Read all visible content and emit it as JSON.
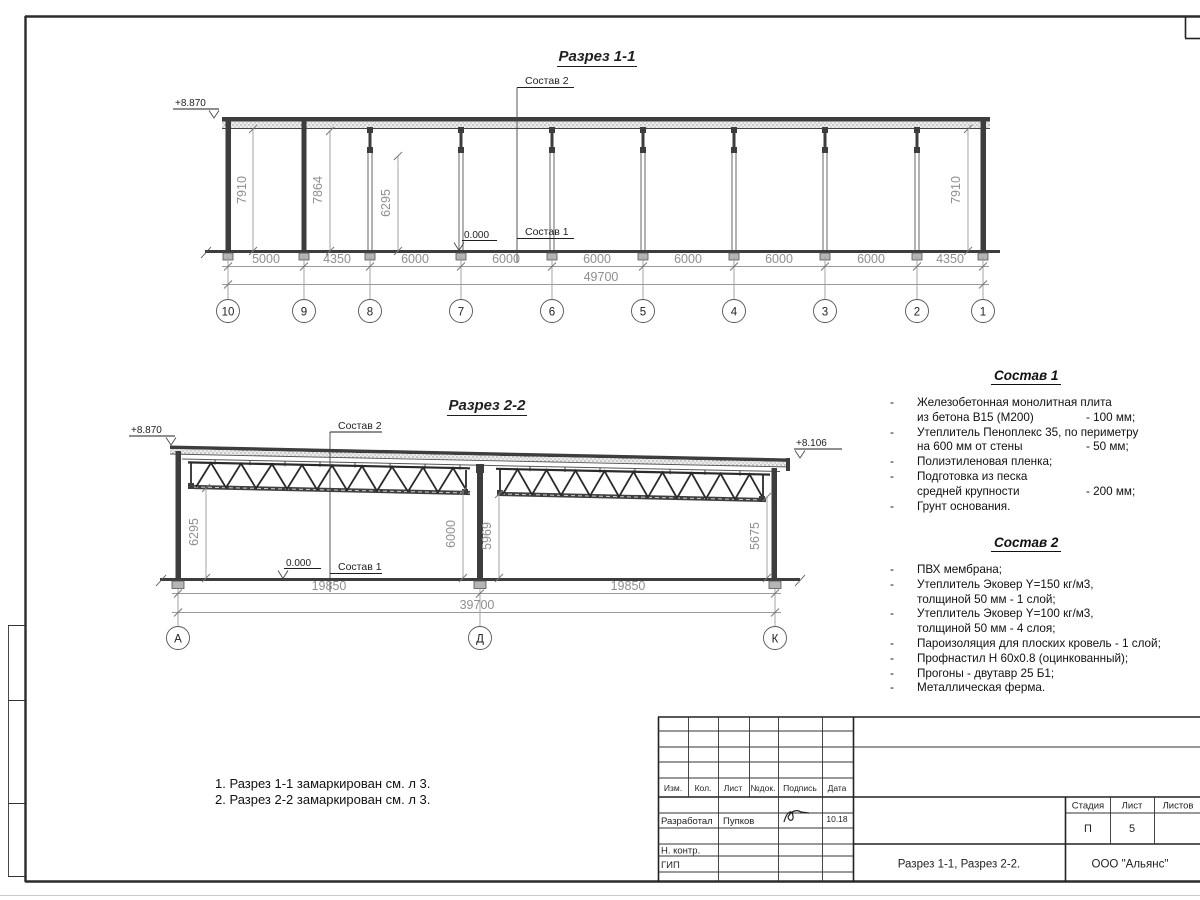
{
  "palette": {
    "ink": "#1f1f1f",
    "dim_grey": "#8f8f8f",
    "structure": "#3d3d3d",
    "footing": "#b5b5b5",
    "paper": "#ffffff"
  },
  "section1": {
    "title": "Разрез 1-1",
    "level_top": "+8.870",
    "level_zero": "0.000",
    "callout_top": "Состав 2",
    "callout_floor": "Состав 1",
    "dims_vertical": [
      "7910",
      "7864",
      "6295",
      "7910"
    ],
    "dims_bays": [
      "5000",
      "4350",
      "6000",
      "6000",
      "6000",
      "6000",
      "6000",
      "6000",
      "4350"
    ],
    "dim_total": "49700",
    "axes": [
      "10",
      "9",
      "8",
      "7",
      "6",
      "5",
      "4",
      "3",
      "2",
      "1"
    ]
  },
  "section2": {
    "title": "Разрез 2-2",
    "level_left": "+8.870",
    "level_right": "+8.106",
    "level_zero": "0.000",
    "callout_top": "Состав 2",
    "callout_floor": "Состав 1",
    "dims_vertical": [
      "6295",
      "6000",
      "5969",
      "5675"
    ],
    "dims_bays": [
      "19850",
      "19850"
    ],
    "dim_total": "39700",
    "axes": [
      "А",
      "Д",
      "К"
    ]
  },
  "sostav1": {
    "title": "Состав 1",
    "items": [
      {
        "d": "-",
        "t": "Железобетонная  монолитная плита",
        "v": ""
      },
      {
        "d": "",
        "t": "из бетона В15 (М200)",
        "v": "- 100 мм;"
      },
      {
        "d": "-",
        "t": "Утеплитель Пеноплекс 35, по периметру",
        "v": ""
      },
      {
        "d": "",
        "t": "на 600 мм от стены",
        "v": "- 50 мм;"
      },
      {
        "d": "-",
        "t": "Полиэтиленовая пленка;",
        "v": ""
      },
      {
        "d": "-",
        "t": "Подготовка из песка",
        "v": ""
      },
      {
        "d": "",
        "t": "средней крупности",
        "v": "- 200 мм;"
      },
      {
        "d": "-",
        "t": "Грунт основания.",
        "v": ""
      }
    ]
  },
  "sostav2": {
    "title": "Состав 2",
    "items": [
      {
        "d": "-",
        "t": "ПВХ мембрана;",
        "v": ""
      },
      {
        "d": "-",
        "t": "Утеплитель Эковер Y=150 кг/м3,",
        "v": ""
      },
      {
        "d": "",
        "t": "толщиной 50 мм - 1 слой;",
        "v": ""
      },
      {
        "d": "-",
        "t": "Утеплитель Эковер Y=100 кг/м3,",
        "v": ""
      },
      {
        "d": "",
        "t": "толщиной 50 мм - 4 слоя;",
        "v": ""
      },
      {
        "d": "-",
        "t": "Пароизоляция для плоских кровель - 1 слой;",
        "v": ""
      },
      {
        "d": "-",
        "t": "Профнастил Н 60х0.8 (оцинкованный);",
        "v": ""
      },
      {
        "d": "-",
        "t": "Прогоны - двутавр 25 Б1;",
        "v": ""
      },
      {
        "d": "-",
        "t": "Металлическая ферма.",
        "v": ""
      }
    ]
  },
  "notes": {
    "line1": "1. Разрез 1-1 замаркирован см. л 3.",
    "line2": "2. Разрез 2-2 замаркирован см. л 3."
  },
  "titleblock": {
    "rev_headers": [
      "Изм.",
      "Кол.",
      "Лист",
      "№док.",
      "Подпись",
      "Дата"
    ],
    "developed_label": "Разработал",
    "developed_name": "Пупков",
    "developed_date": "10.18",
    "ncontr_label": "Н. контр.",
    "gip_label": "ГИП",
    "stage_label": "Стадия",
    "sheet_label": "Лист",
    "sheets_label": "Листов",
    "stage_value": "П",
    "sheet_value": "5",
    "doc_title": "Разрез 1-1, Разрез 2-2.",
    "company": "ООО \"Альянс\""
  }
}
